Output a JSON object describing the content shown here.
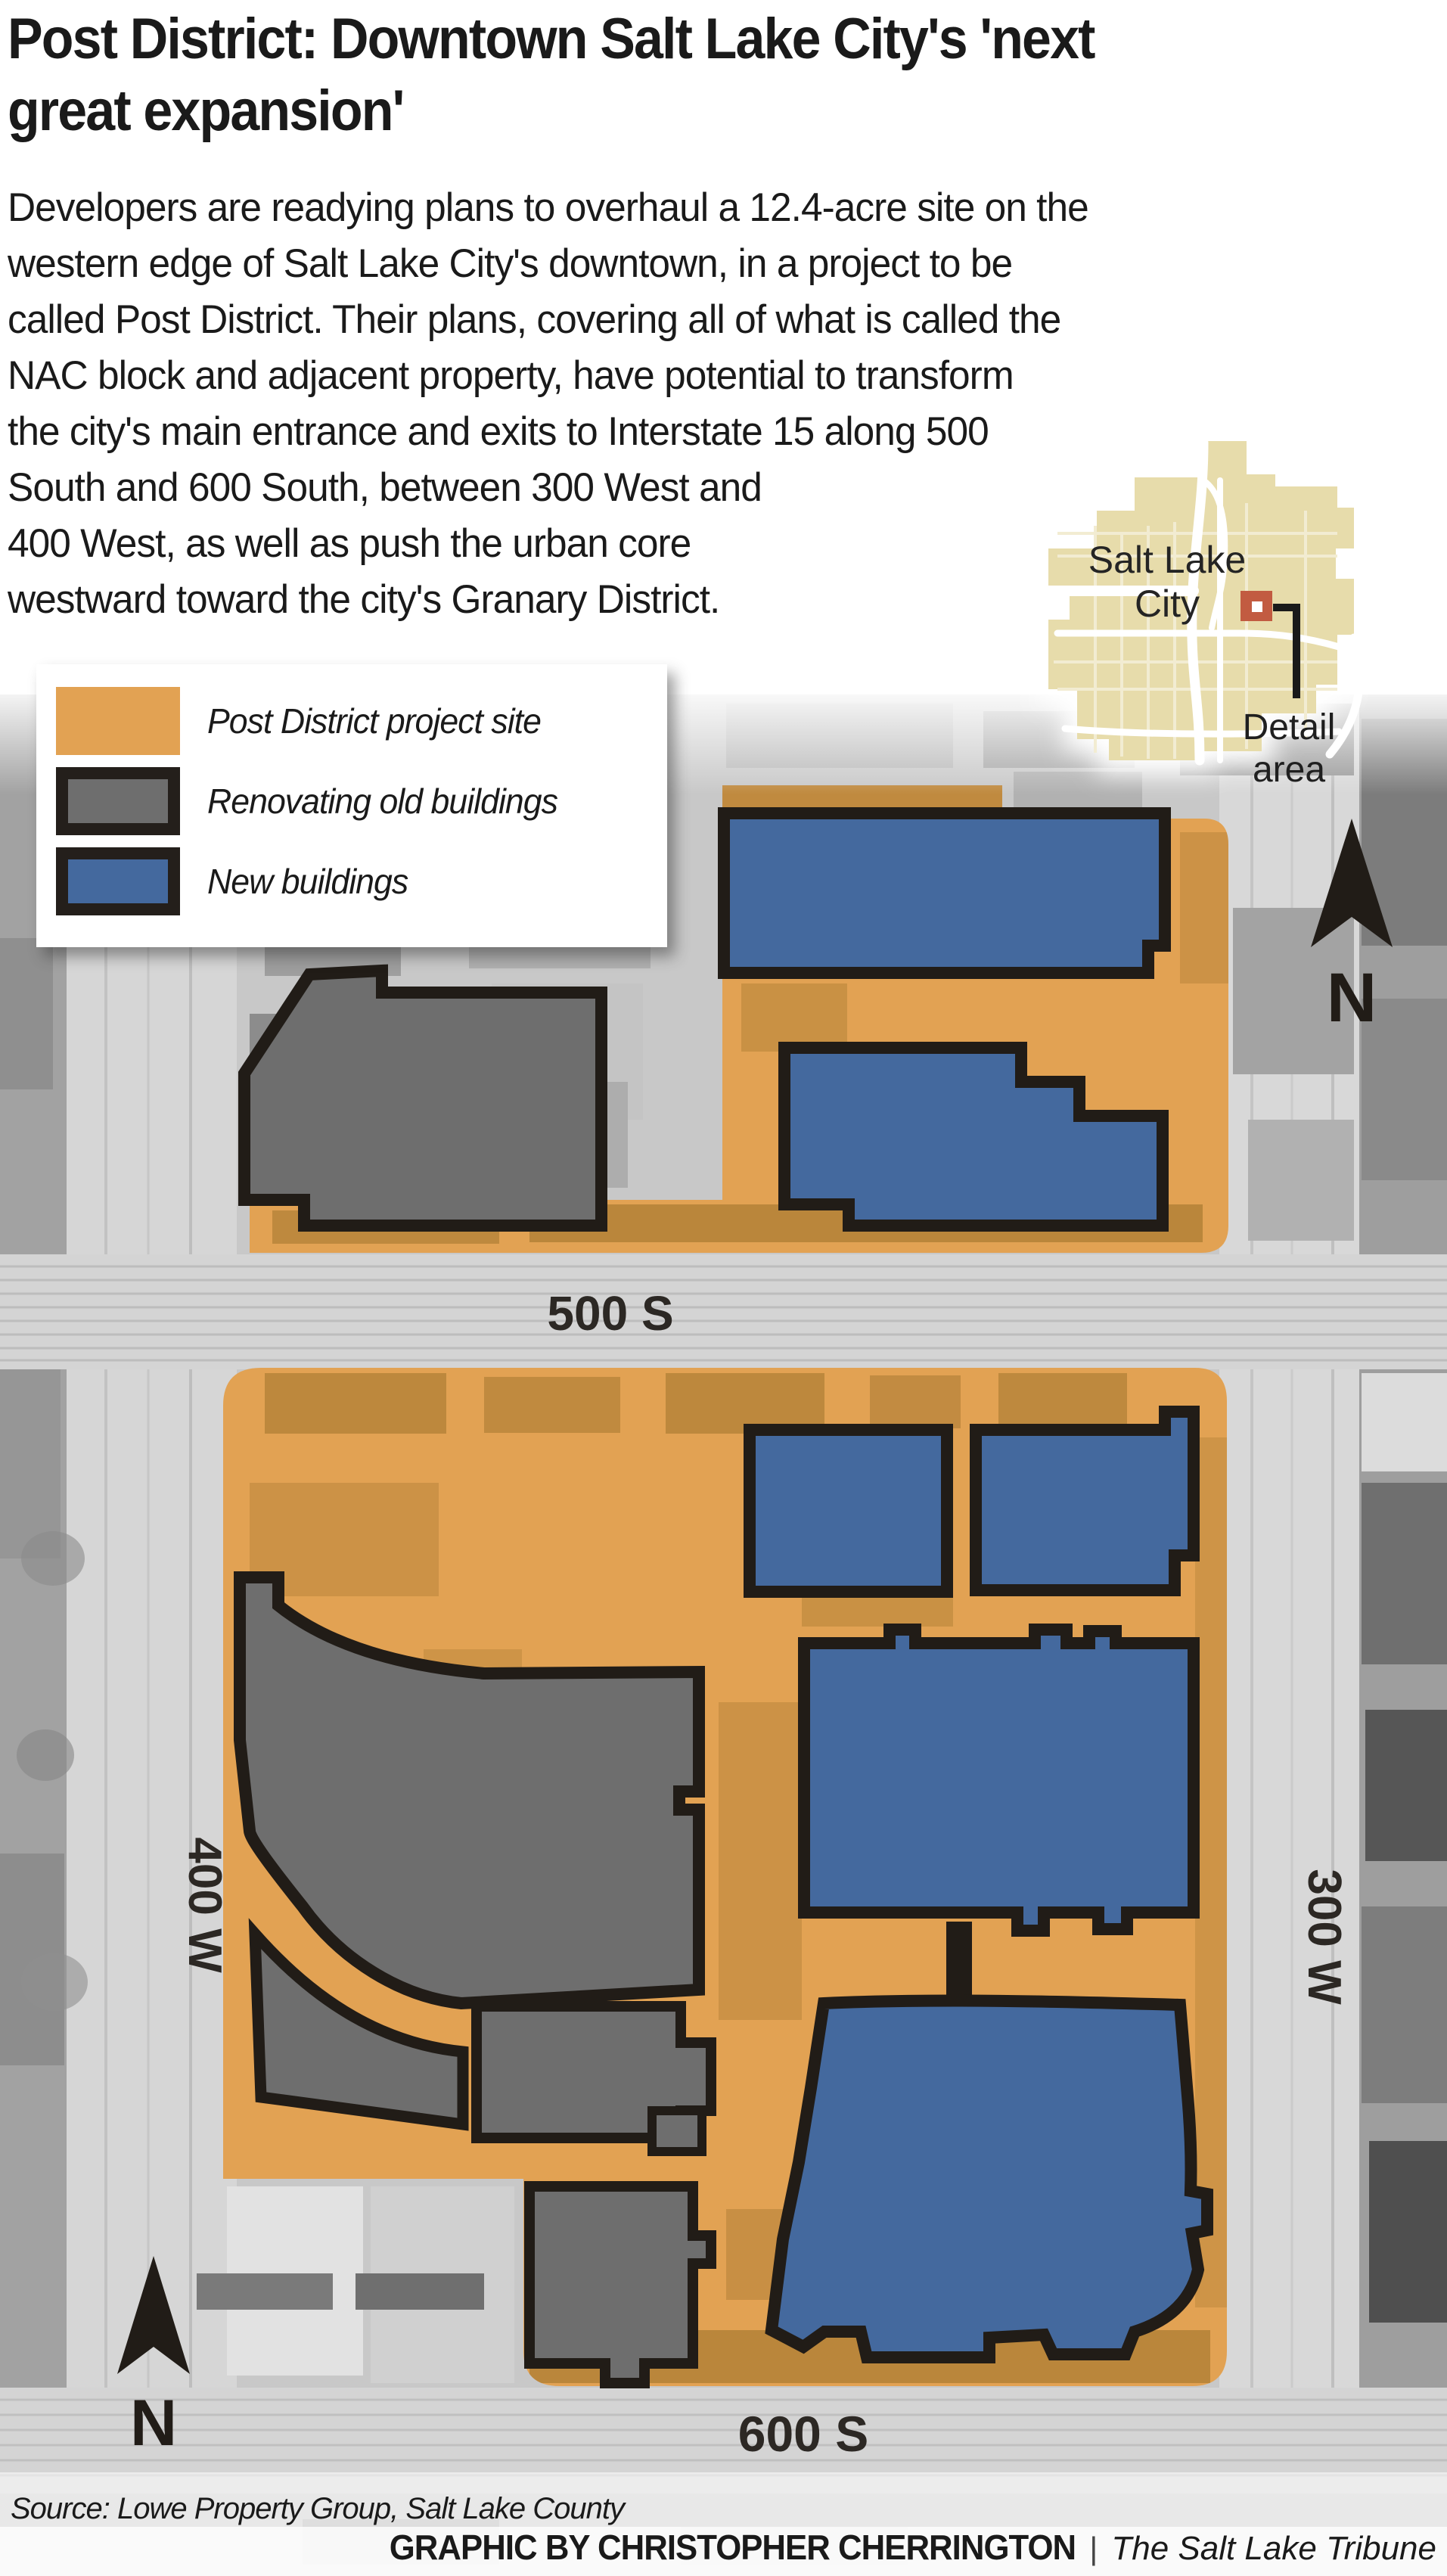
{
  "title": "Post District: Downtown Salt Lake City's 'next great expansion'",
  "headline_lines": [
    "Post District: Downtown Salt Lake City's 'next",
    "great expansion'"
  ],
  "intro_lines": [
    "Developers are readying plans to overhaul a 12.4-acre site on the",
    "western edge of Salt Lake City's downtown, in a project to be",
    "called Post District. Their plans, covering all of what is called the",
    "NAC block and adjacent property, have potential to transform",
    "the city's main entrance and exits to Interstate 15 along 500",
    "South and 600 South, between 300 West and",
    "400 West, as well as push the urban core",
    "westward toward the city's Granary District."
  ],
  "legend": {
    "items": [
      {
        "label": "Post District project site",
        "color": "#E2A253",
        "border_color": "transparent",
        "flat": "yes"
      },
      {
        "label": "Renovating old buildings",
        "color": "#6E6E6E",
        "border_color": "#241F1B",
        "flat": "no"
      },
      {
        "label": "New buildings",
        "color": "#44699E",
        "border_color": "#241F1B",
        "flat": "no"
      }
    ]
  },
  "inset": {
    "city_label_line1": "Salt Lake",
    "city_label_line2": "City",
    "detail_label_line1": "Detail",
    "detail_label_line2": "area"
  },
  "map": {
    "street_labels": {
      "s500": "500 S",
      "s600": "600 S",
      "w400": "400 W",
      "w300": "300 W"
    },
    "north_label": "N"
  },
  "footer": {
    "source": "Source: Lowe Property Group, Salt Lake County",
    "credit_bold": "GRAPHIC BY CHRISTOPHER CHERRINGTON",
    "credit_sep": "|",
    "credit_pub": "The Salt Lake Tribune"
  },
  "colors": {
    "site-orange": "#E2A253",
    "orange-shade": "#8A6420",
    "reno-gray": "#6E6E6E",
    "new-blue": "#44699E",
    "ink": "#211C17",
    "street-label": "#2C2824",
    "aerial-base": "#C8C8C8",
    "road-gray": "#D6D6D6",
    "inset-tan": "#E7DCAB",
    "inset-road-cream": "#F2ECD2",
    "marker-red": "#C25B41",
    "text-black": "#1A1A1A"
  }
}
